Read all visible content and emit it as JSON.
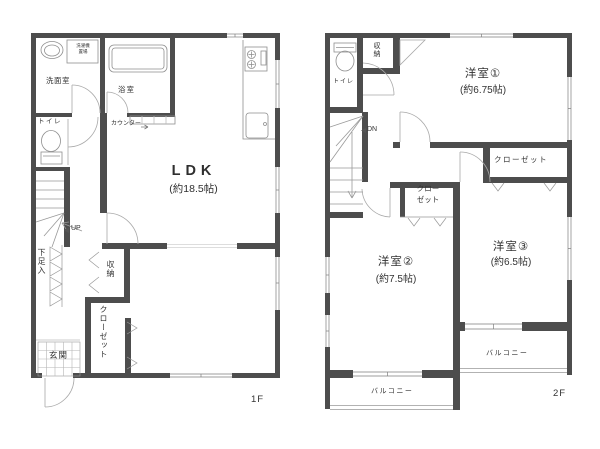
{
  "palette": {
    "wall": "#4d4d4d",
    "thin_line": "#999999",
    "light_line": "#bbbbbb",
    "text": "#333333",
    "background": "#ffffff"
  },
  "floor1": {
    "floor_label": "1F",
    "washroom": "洗面室",
    "laundry_line1": "洗濯機",
    "laundry_line2": "置場",
    "bath": "浴室",
    "counter": "カウンター",
    "ldk": "LDK",
    "ldk_size": "(約18.5帖)",
    "toilet": "トイレ",
    "up": "UP",
    "shoe_cabinet": "下足入",
    "storage": "収納",
    "closet": "クローゼット",
    "entrance": "玄関"
  },
  "floor2": {
    "floor_label": "2F",
    "toilet": "トイレ",
    "storage": "収納",
    "dn": "DN",
    "room1": "洋室①",
    "room1_size": "(約6.75帖)",
    "closet_room3": "クローゼット",
    "closet_room2_line1": "クロー",
    "closet_room2_line2": "ゼット",
    "room2": "洋室②",
    "room2_size": "(約7.5帖)",
    "room3": "洋室③",
    "room3_size": "(約6.5帖)",
    "balcony_room3": "バルコニー",
    "balcony_room2": "バルコニー"
  }
}
